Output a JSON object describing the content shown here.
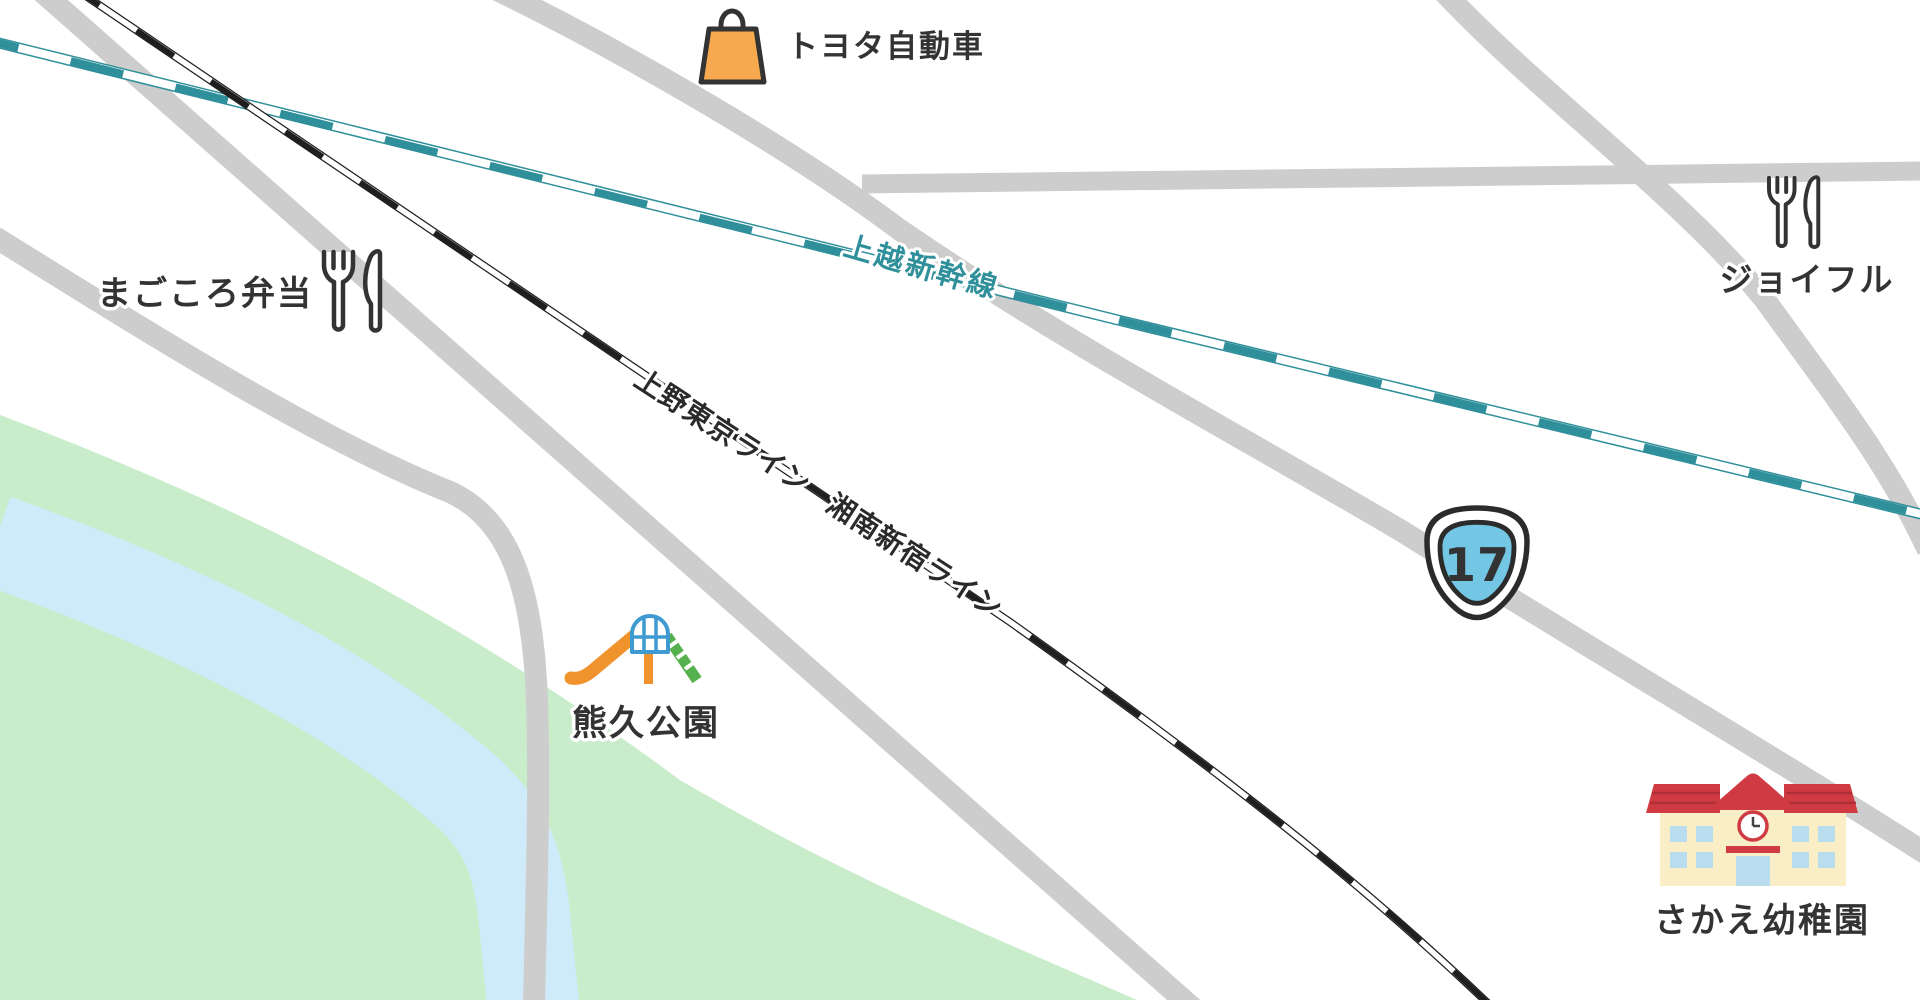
{
  "map_type": "stylized-local-map",
  "colors": {
    "background": "#ffffff",
    "road": "#cdcdcd",
    "green_area": "#c9edcb",
    "river": "#cfeaf8",
    "rail_jr": "#1f1f1f",
    "rail_shinkansen": "#2f8f9a",
    "label_text": "#333333",
    "shield_blue": "#74c7e4",
    "bag_orange": "#f6a94e",
    "slide_orange": "#f0932c",
    "slide_arch_blue": "#3f9ad2",
    "ladder_green": "#54b14d",
    "school_roof_red": "#cf3a43",
    "school_wall_cream": "#f9eec6",
    "school_window_blue": "#b9ddee"
  },
  "railways": [
    {
      "name": "上越新幹線",
      "type": "shinkansen",
      "color": "#2f8f9a"
    },
    {
      "name": "上野東京ライン",
      "type": "jr",
      "color": "#1f1f1f"
    },
    {
      "name": "湘南新宿ライン",
      "type": "jr",
      "color": "#1f1f1f"
    }
  ],
  "route_shield": {
    "number": "17",
    "fill": "#74c7e4"
  },
  "places": [
    {
      "id": "toyota",
      "label": "トヨタ自動車",
      "icon": "shopping-bag-icon"
    },
    {
      "id": "magokoro-bento",
      "label": "まごころ弁当",
      "icon": "fork-knife-icon"
    },
    {
      "id": "joyful",
      "label": "ジョイフル",
      "icon": "fork-knife-icon"
    },
    {
      "id": "kumahisa-park",
      "label": "熊久公園",
      "icon": "playground-slide-icon"
    },
    {
      "id": "sakae-kindergarten",
      "label": "さかえ幼稚園",
      "icon": "school-icon"
    }
  ]
}
